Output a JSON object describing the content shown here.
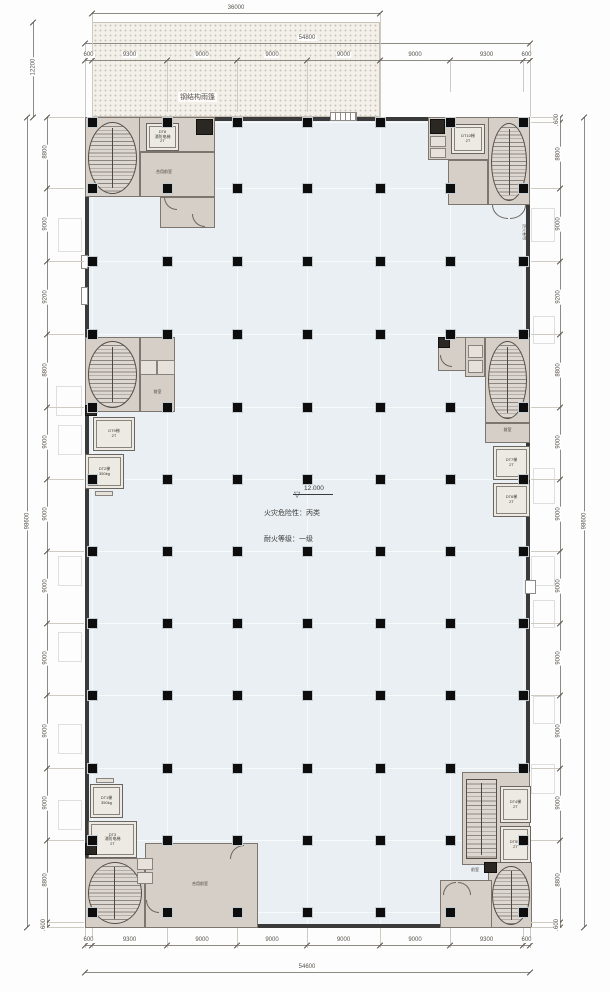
{
  "canopy": {
    "label": "钢结构雨篷"
  },
  "dims": {
    "canopy_width": "36000",
    "canopy_depth": "12200",
    "top_overall": "54800",
    "bottom_overall": "54600",
    "side_overall_left": "98600",
    "side_overall_right": "98600",
    "top_chain": [
      "600",
      "9300",
      "9000",
      "9000",
      "9000",
      "9000",
      "9300",
      "600"
    ],
    "bottom_chain": [
      "600",
      "9300",
      "9000",
      "9000",
      "9000",
      "9000",
      "9300",
      "600"
    ],
    "left_chain": [
      "8800",
      "9000",
      "9200",
      "8800",
      "9000",
      "9000",
      "9000",
      "9000",
      "9000",
      "9000",
      "8800",
      "600"
    ],
    "right_chain": [
      "600",
      "8800",
      "9000",
      "9200",
      "8800",
      "9000",
      "9000",
      "9000",
      "9000",
      "9000",
      "9000",
      "8800",
      "600"
    ]
  },
  "annotation": {
    "elevation": "12.000",
    "line1": "火灾危险性：丙类",
    "line2": "耐火等级：一级"
  },
  "cores": {
    "top_left": {
      "elevator": "DT8\n消防电梯\n2T",
      "lobby": "合用前室"
    },
    "top_right": {
      "elevator": "DT10梯\n2T"
    },
    "mid_left": {
      "elevator1": "DT9梯\n2T",
      "elevator2": "DT2梯\n350kg",
      "lobby": "前室"
    },
    "mid_right": {
      "elevator1": "DT7梯\n2T",
      "elevator2": "DT6梯\n2T",
      "lobby": "前室"
    },
    "bottom_left": {
      "elevator1": "DT1梯\n350kg",
      "elevator2": "DT3\n消防电梯\n2T",
      "room": "合用前室"
    },
    "bottom_right": {
      "elevator1": "DT4梯\n2T",
      "elevator2": "DT5梯\n2T",
      "lobby": "前室"
    }
  },
  "wall_tag": "防火卷帘",
  "colors": {
    "wall": "#3a3a3a",
    "floor_fill": "#e9eff3",
    "core_fill": "#d5cfc7",
    "column": "#0d0d0d",
    "canopy_fill": "#f3f0ea",
    "dimension": "#55504a"
  }
}
